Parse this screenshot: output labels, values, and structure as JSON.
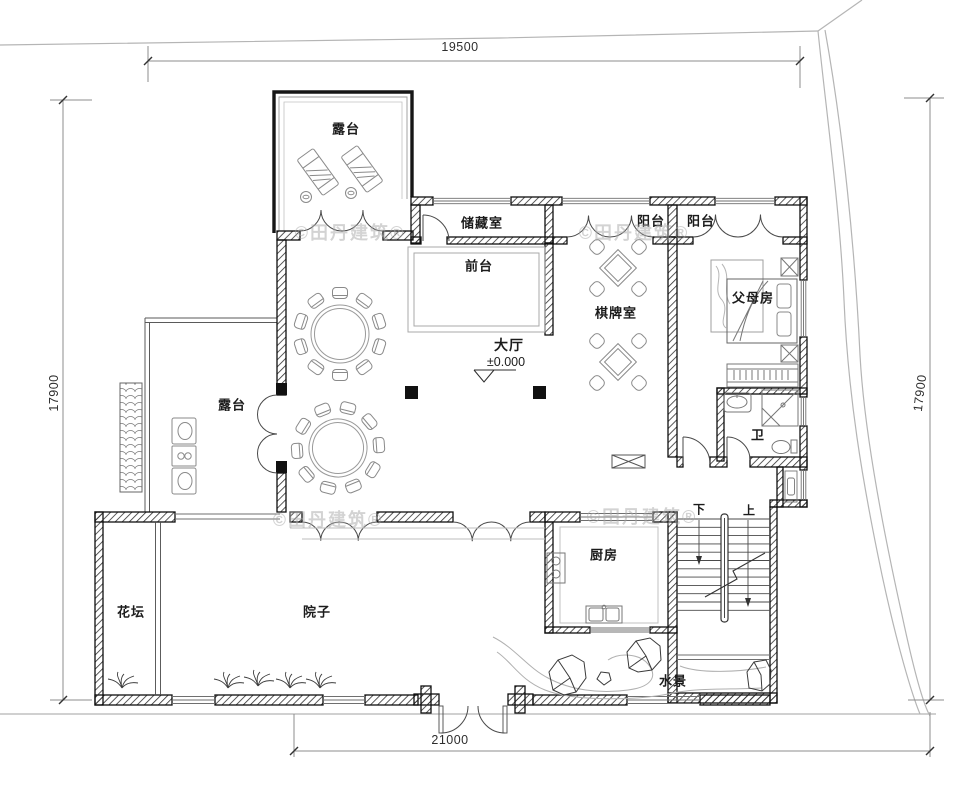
{
  "drawing": {
    "dimensions": {
      "top": "19500",
      "bottom": "21000",
      "left": "17900",
      "right": "17900"
    },
    "labels": {
      "terrace_top": "露台",
      "storage": "储藏室",
      "reception": "前台",
      "balcony_left": "阳台",
      "balcony_right": "阳台",
      "chess_room": "棋牌室",
      "parents_room": "父母房",
      "hall": "大厅",
      "hall_level": "±0.000",
      "terrace_side": "露台",
      "bath": "卫",
      "kitchen": "厨房",
      "stair_down": "下",
      "stair_up": "上",
      "flower_bed": "花坛",
      "courtyard": "院子",
      "water_feature": "水景"
    },
    "watermark": "©田丹建筑®",
    "colors": {
      "wall": "#141414",
      "furniture_line": "#6f6f6f",
      "site_line": "#b5b5b5",
      "dim_line": "#8c8c8c",
      "text": "#1c1c1c",
      "watermark": "#a8a8a8"
    }
  }
}
